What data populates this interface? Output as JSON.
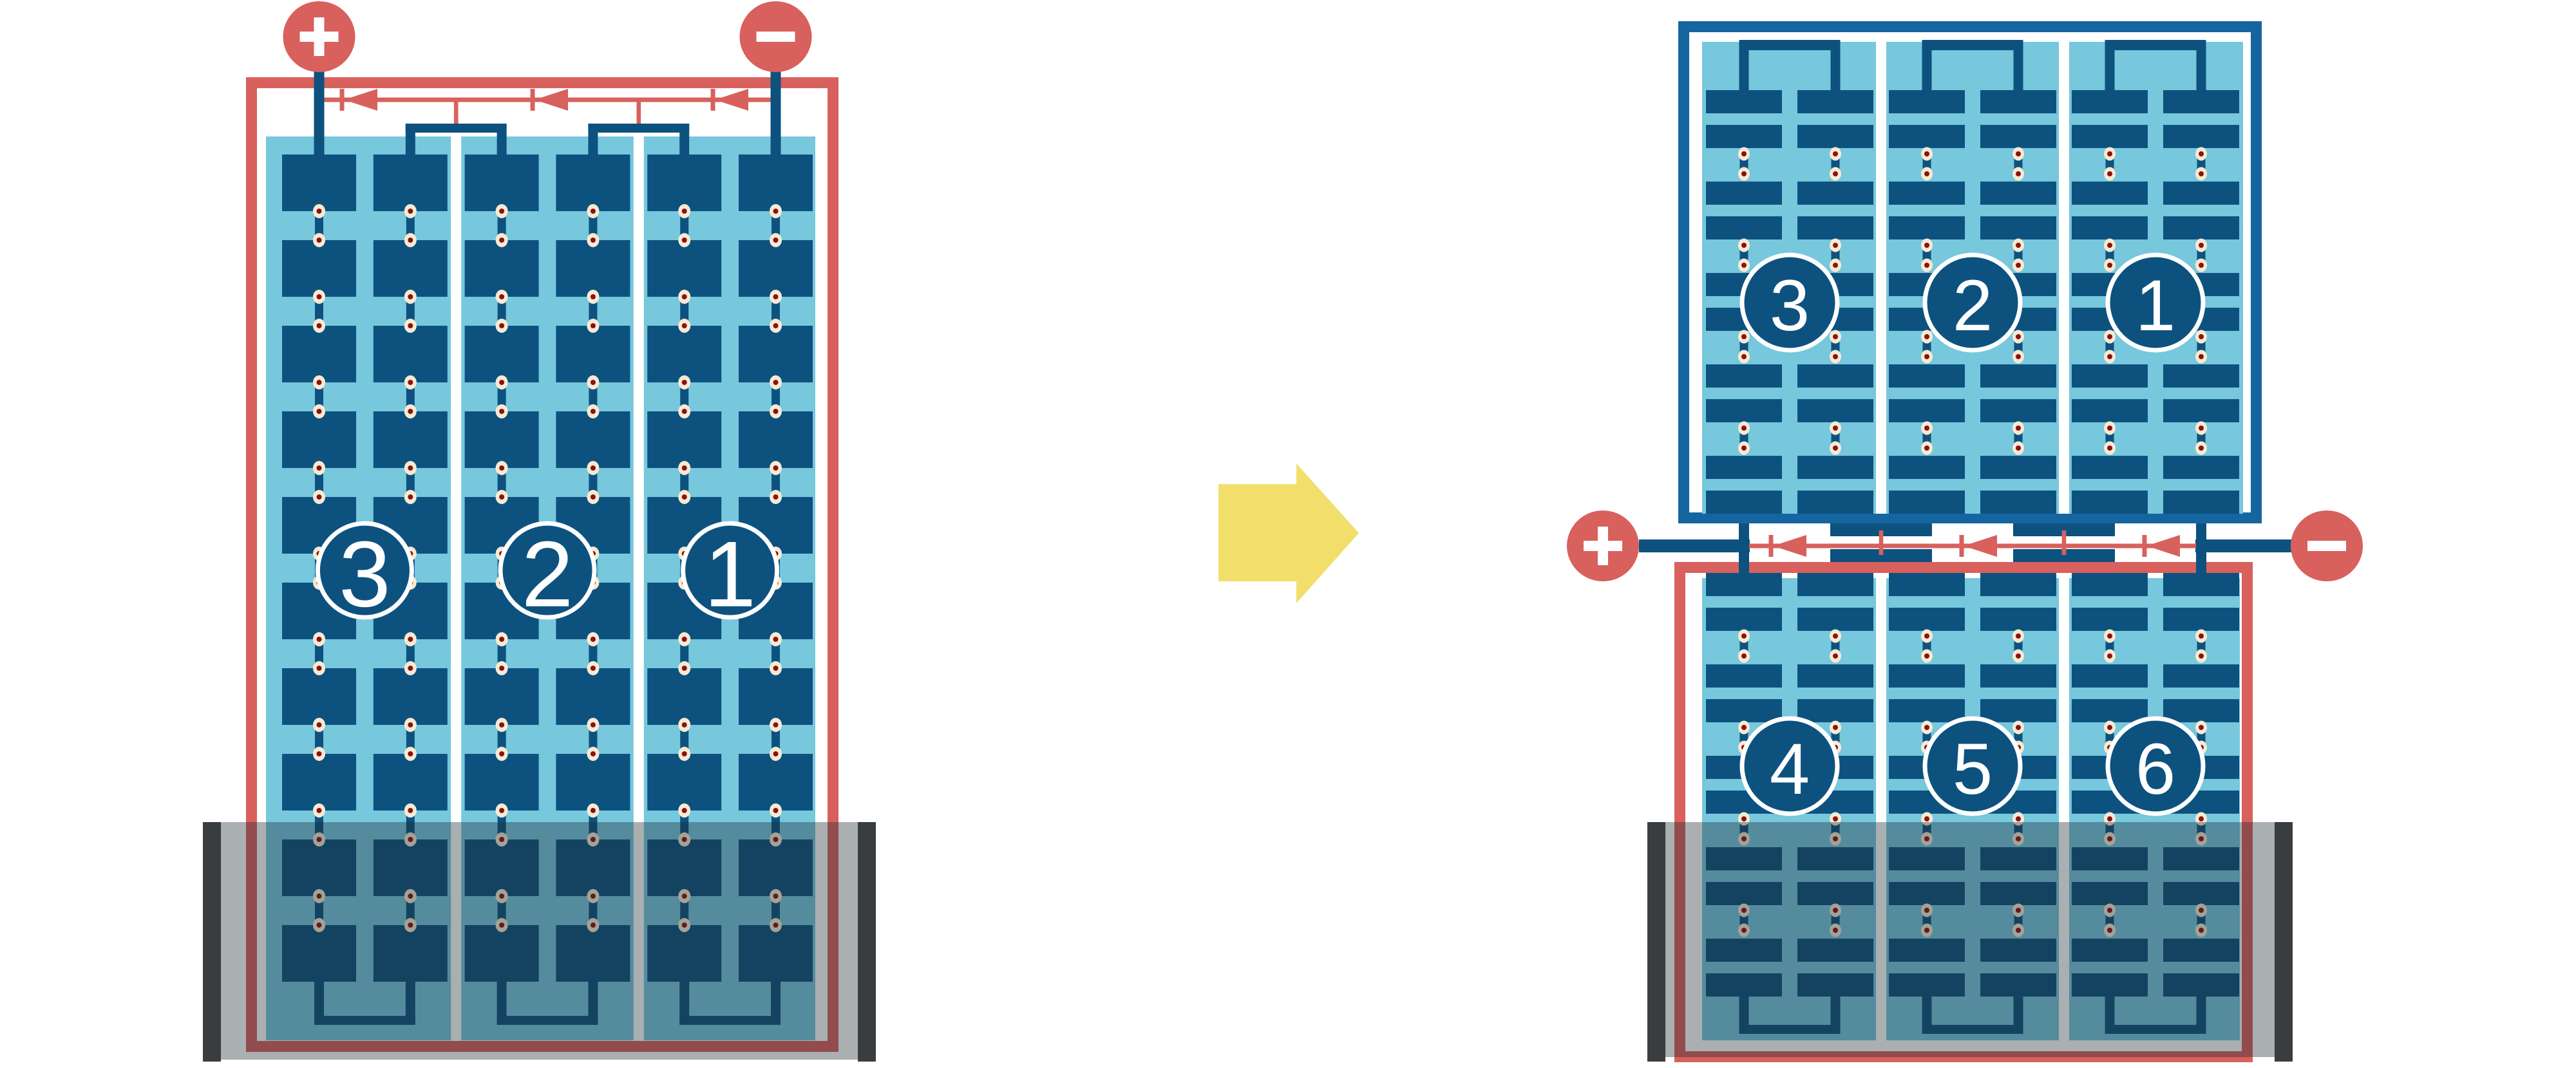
{
  "colors": {
    "background": "#ffffff",
    "red": "#D8605D",
    "dark_red": "#8B1213",
    "cream": "#F6EAD2",
    "cell_blue": "#0D527F",
    "panel_blue": "#77C7DD",
    "frame_blue": "#1565A0",
    "white": "#ffffff",
    "shade_overlay": "rgba(32,45,53,0.38)",
    "shade_post": "#3A3D3F",
    "arrow_yellow": "#F2DE6B"
  },
  "left_module": {
    "string_labels": [
      "3",
      "2",
      "1"
    ],
    "plus_label": "+",
    "minus_label": "−",
    "bypass_diode_count": 3
  },
  "right_module": {
    "top_string_labels": [
      "3",
      "2",
      "1"
    ],
    "bottom_string_labels": [
      "4",
      "5",
      "6"
    ],
    "plus_label": "+",
    "minus_label": "−",
    "bypass_diode_count": 3
  }
}
